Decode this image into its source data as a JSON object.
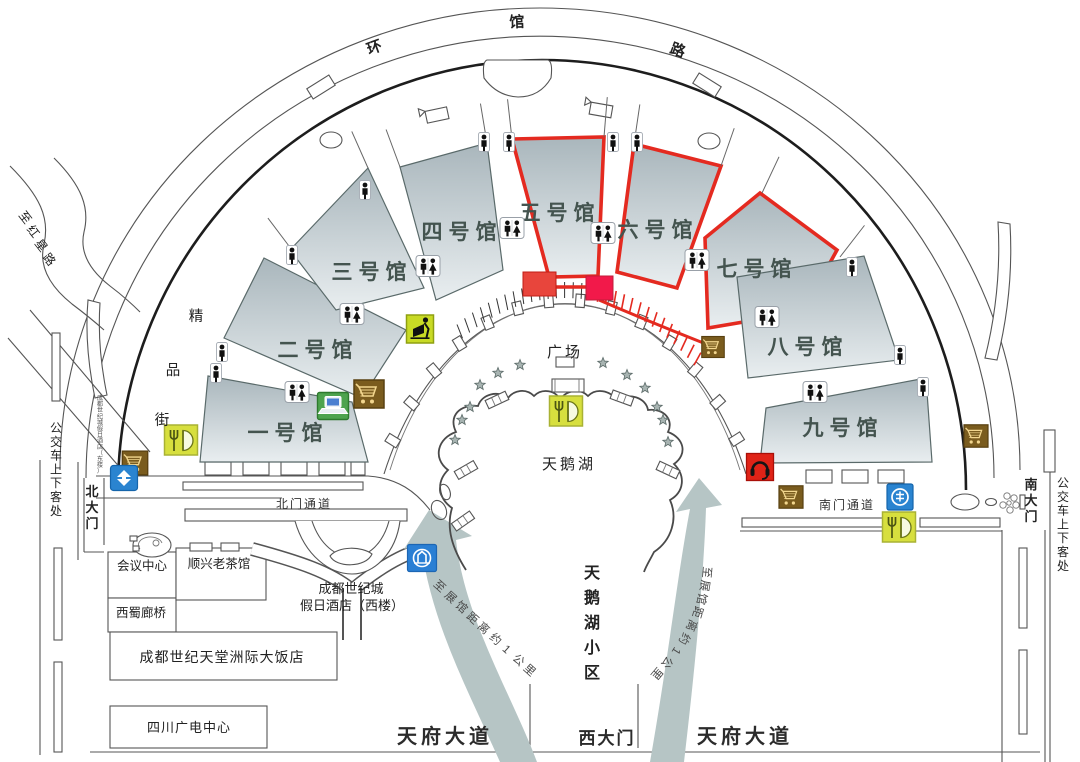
{
  "roads": {
    "ring": "环馆路",
    "hongxing": "至红星路",
    "boutique": "精品街",
    "bus_stop_left": "公交车上下客处",
    "bus_stop_right": "公交车上下客处",
    "north_passage": "北门通道",
    "south_passage": "南门通道",
    "tianfu_left": "天府大道",
    "tianfu_right": "天府大道"
  },
  "gates": {
    "north": "北大门",
    "south": "南大门",
    "west": "西大门"
  },
  "halls": [
    {
      "name": "一号馆",
      "highlighted": false
    },
    {
      "name": "二号馆",
      "highlighted": false
    },
    {
      "name": "三号馆",
      "highlighted": false
    },
    {
      "name": "四号馆",
      "highlighted": false
    },
    {
      "name": "五号馆",
      "highlighted": true
    },
    {
      "name": "六号馆",
      "highlighted": true
    },
    {
      "name": "七号馆",
      "highlighted": true
    },
    {
      "name": "八号馆",
      "highlighted": false
    },
    {
      "name": "九号馆",
      "highlighted": false
    }
  ],
  "center": {
    "plaza": "广场",
    "lake": "天鹅湖",
    "lake_block": "天鹅湖小区"
  },
  "buildings": {
    "conference": "会议中心",
    "teahouse": "顺兴老茶馆",
    "bridge": "西蜀廊桥",
    "holiday_hotel_line1": "成都世纪城",
    "holiday_hotel_line2": "假日酒店（西楼）",
    "holiday_hotel_east": "成都世纪城假日酒店（东楼）",
    "intercontinental": "成都世纪天堂洲际大饭店",
    "broadcast": "四川广电中心"
  },
  "arrows": {
    "left_text": "至展馆距离约1公里",
    "right_text": "至展馆距离约1公里"
  },
  "colors": {
    "highlight_red": "#e42a20",
    "entrance_red_1": "#e8453c",
    "entrance_red_2": "#f2194a",
    "arrow_gray": "#b6c5c5",
    "hall_top": "#a9b6bc",
    "hall_bottom": "#e9eef0",
    "restaurant_green": "#d7df3e",
    "cart_brown": "#7a5c1e",
    "atm_green": "#c8da25",
    "bank_blue": "#2a84d0",
    "service_red": "#e02317",
    "laptop_green": "#4ea34e"
  },
  "icons": [
    {
      "type": "restroom-icon",
      "x": 297,
      "y": 392
    },
    {
      "type": "restroom-icon",
      "x": 352,
      "y": 314
    },
    {
      "type": "restroom-icon",
      "x": 428,
      "y": 266
    },
    {
      "type": "restroom-icon",
      "x": 512,
      "y": 228
    },
    {
      "type": "restroom-icon",
      "x": 603,
      "y": 233
    },
    {
      "type": "restroom-icon",
      "x": 697,
      "y": 260
    },
    {
      "type": "restroom-icon",
      "x": 767,
      "y": 317
    },
    {
      "type": "restroom-icon",
      "x": 815,
      "y": 392
    },
    {
      "type": "person-icon",
      "x": 222,
      "y": 352
    },
    {
      "type": "person-icon",
      "x": 216,
      "y": 373
    },
    {
      "type": "person-icon",
      "x": 292,
      "y": 255
    },
    {
      "type": "person-icon",
      "x": 365,
      "y": 190
    },
    {
      "type": "person-icon",
      "x": 484,
      "y": 142
    },
    {
      "type": "person-icon",
      "x": 509,
      "y": 142
    },
    {
      "type": "person-icon",
      "x": 613,
      "y": 142
    },
    {
      "type": "person-icon",
      "x": 637,
      "y": 142
    },
    {
      "type": "person-icon",
      "x": 852,
      "y": 267
    },
    {
      "type": "person-icon",
      "x": 900,
      "y": 355
    },
    {
      "type": "person-icon",
      "x": 923,
      "y": 387
    },
    {
      "type": "restaurant-icon",
      "x": 181,
      "y": 440
    },
    {
      "type": "restaurant-icon",
      "x": 566,
      "y": 411
    },
    {
      "type": "restaurant-icon",
      "x": 899,
      "y": 527
    },
    {
      "type": "shopping-cart-icon",
      "x": 369,
      "y": 394,
      "s": 1.0
    },
    {
      "type": "shopping-cart-icon",
      "x": 135,
      "y": 463,
      "s": 0.85
    },
    {
      "type": "shopping-cart-icon",
      "x": 713,
      "y": 347,
      "s": 0.75
    },
    {
      "type": "shopping-cart-icon",
      "x": 791,
      "y": 497,
      "s": 0.8
    },
    {
      "type": "shopping-cart-icon",
      "x": 976,
      "y": 436,
      "s": 0.8
    },
    {
      "type": "atm-icon",
      "x": 420,
      "y": 329
    },
    {
      "type": "laptop-icon",
      "x": 333,
      "y": 406
    },
    {
      "type": "ccb-bank-icon",
      "x": 124,
      "y": 478
    },
    {
      "type": "metro-icon",
      "x": 422,
      "y": 558
    },
    {
      "type": "bank-icon",
      "x": 900,
      "y": 497
    },
    {
      "type": "customer-service-icon",
      "x": 760,
      "y": 467
    }
  ]
}
